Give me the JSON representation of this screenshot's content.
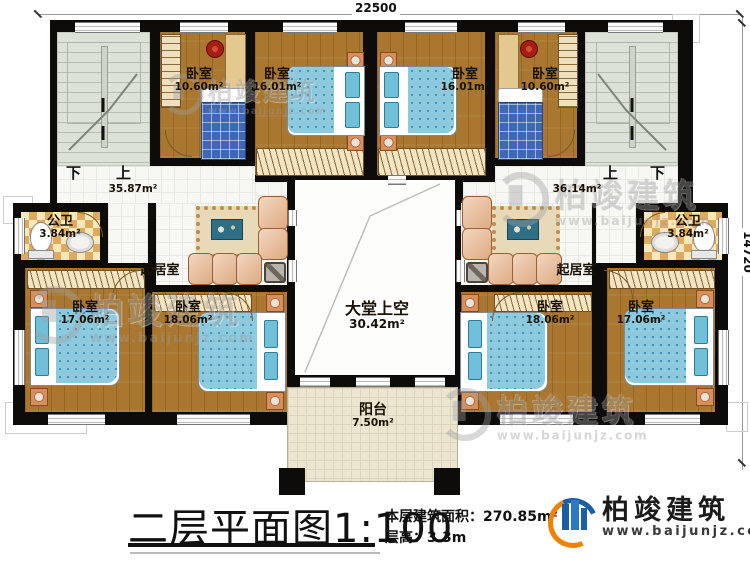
{
  "dimensions": {
    "top": "22500",
    "right": "14720"
  },
  "stairs": {
    "left": {
      "down": "下",
      "up": "上",
      "area": "35.87m²"
    },
    "right": {
      "up": "上",
      "down": "下",
      "area": "36.14m²"
    }
  },
  "rooms": {
    "bedroom_top_left_small": {
      "label": "卧室",
      "area": "10.60m²"
    },
    "bedroom_top_left_large": {
      "label": "卧室",
      "area": "16.01m²"
    },
    "bedroom_top_right_large": {
      "label": "卧室",
      "area": "16.01m²"
    },
    "bedroom_top_right_small": {
      "label": "卧室",
      "area": "10.60m²"
    },
    "bath_left": {
      "label": "公卫",
      "area": "3.84m²"
    },
    "bath_right": {
      "label": "公卫",
      "area": "3.84m²"
    },
    "living_left": {
      "label": "起居室"
    },
    "living_right": {
      "label": "起居室"
    },
    "bedroom_bottom_left_outer": {
      "label": "卧室",
      "area": "17.06m²"
    },
    "bedroom_bottom_left_inner": {
      "label": "卧室",
      "area": "18.06m²"
    },
    "bedroom_bottom_right_inner": {
      "label": "卧室",
      "area": "18.06m²"
    },
    "bedroom_bottom_right_outer": {
      "label": "卧室",
      "area": "17.06m²"
    },
    "hall_void": {
      "label": "大堂上空",
      "area": "30.42m²"
    },
    "balcony": {
      "label": "阳台",
      "area": "7.50m²"
    }
  },
  "title_block": {
    "title": "二层平面图",
    "scale": "1:100",
    "area_label": "本层建筑面积：",
    "area_value": "270.85m²",
    "height_label": "层高：",
    "height_value": "3.3m"
  },
  "logo": {
    "name": "柏竣建筑",
    "url": "www.baijunjz.com"
  },
  "watermark": {
    "text": "柏竣建筑",
    "url": "www.baijunjz.com"
  },
  "colors": {
    "wall": "#0d0c0a",
    "wood": "#a9772f",
    "bed_blue": "#8ecade",
    "accent_orange": "#ef8200",
    "accent_blue": "#1b5ea6"
  }
}
